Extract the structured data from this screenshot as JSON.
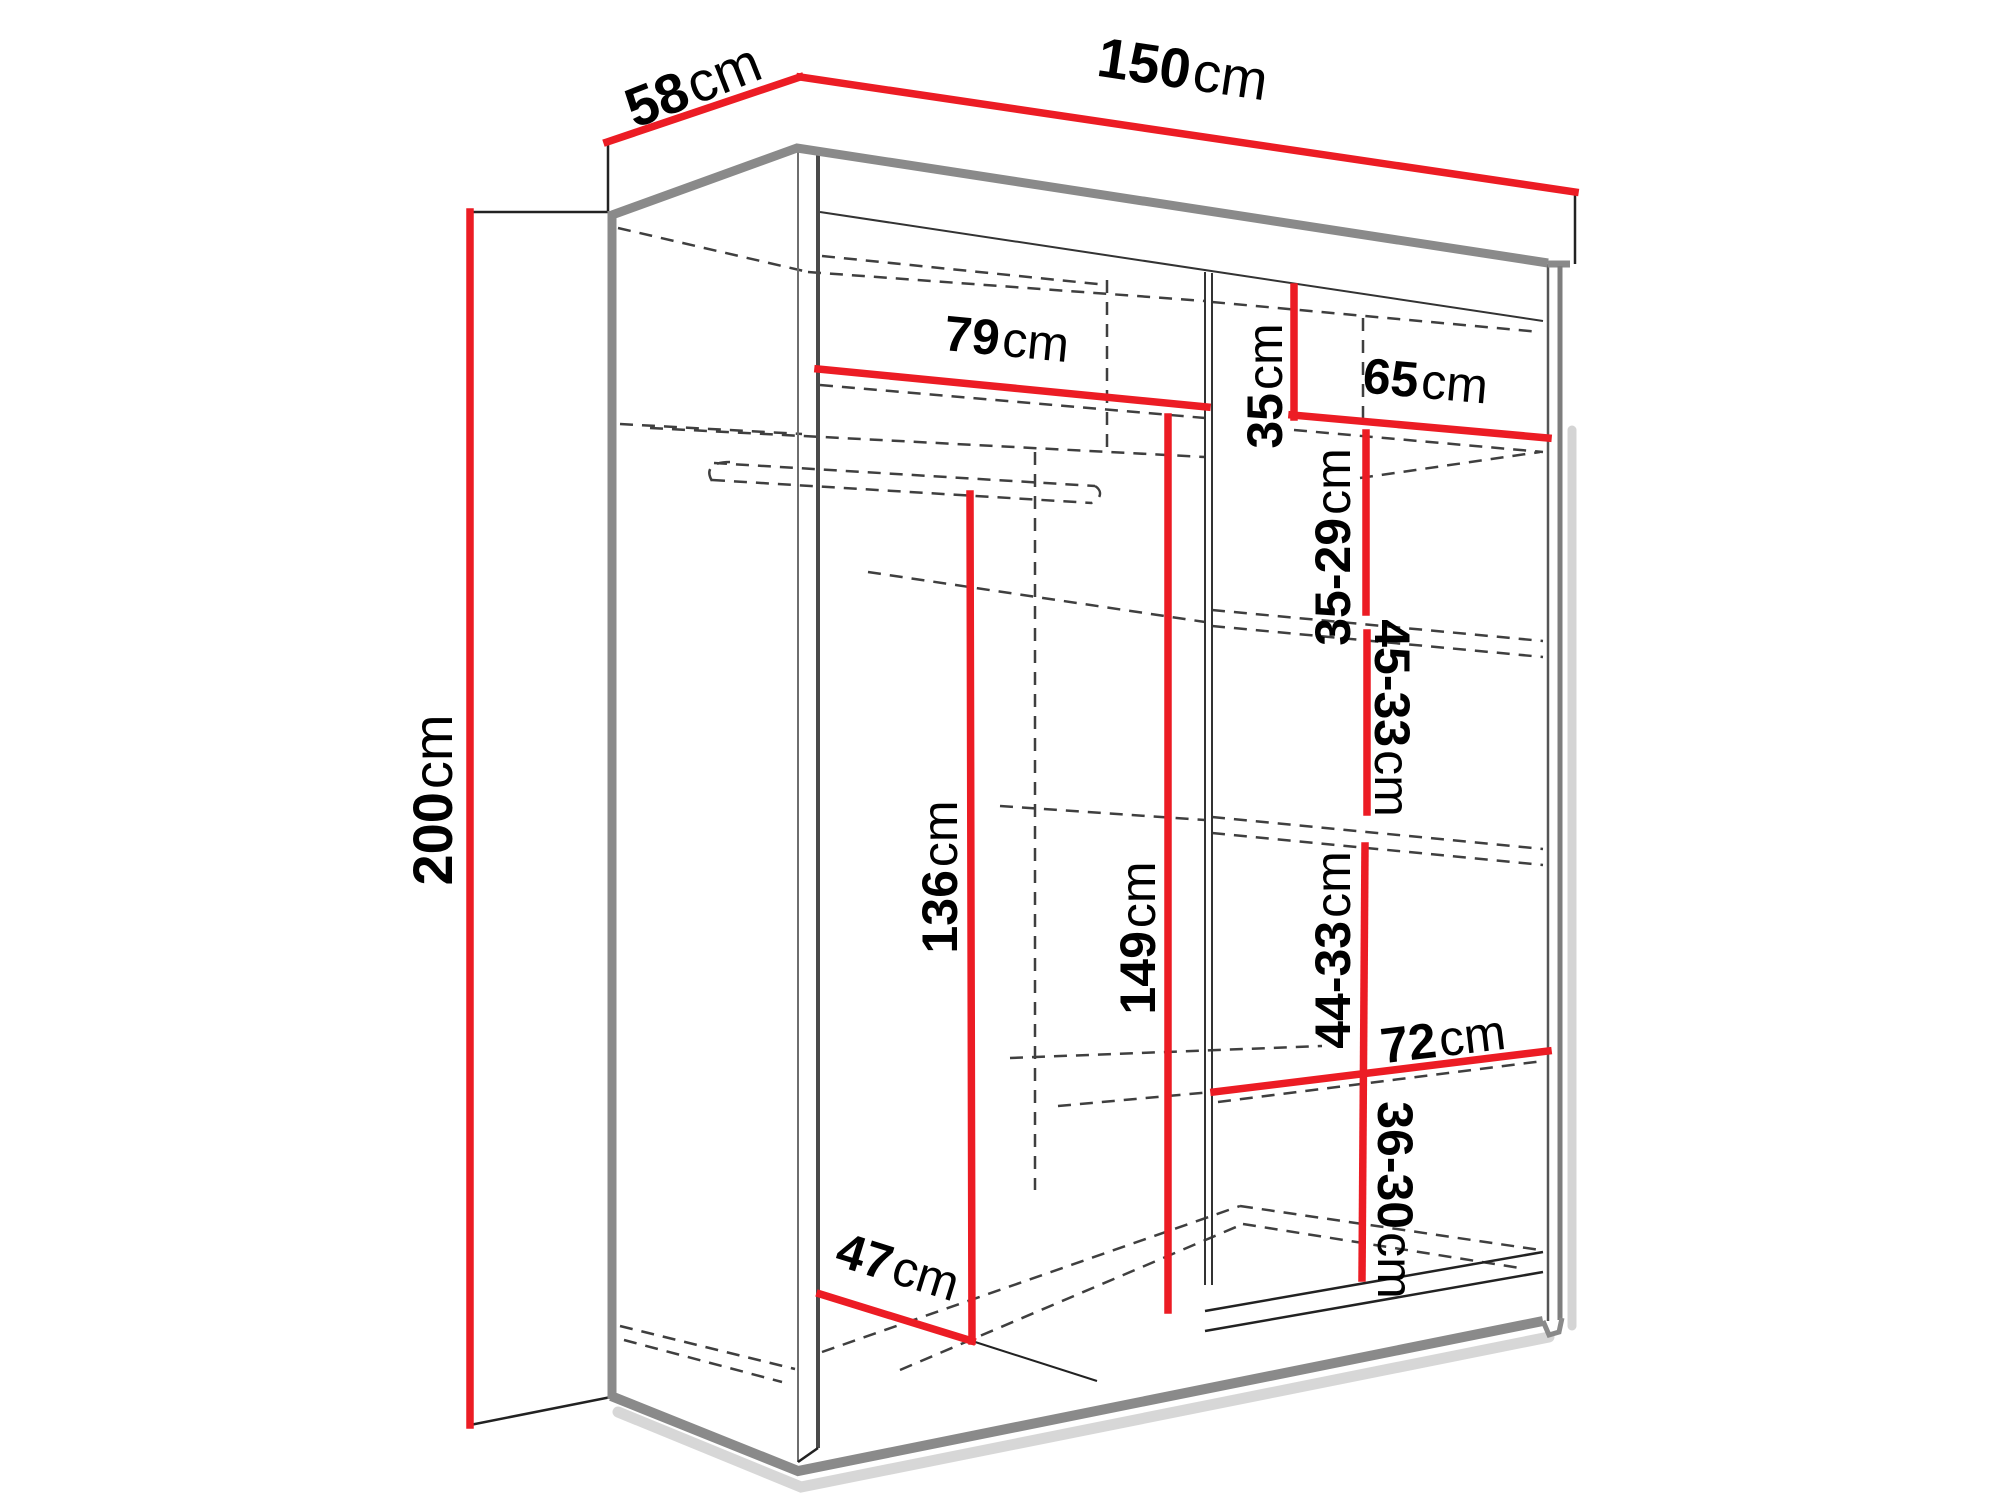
{
  "unit": "cm",
  "colors": {
    "dimension_line": "#ec1c24",
    "structure_line": "#8a8a8a",
    "edge_line": "#222222",
    "dashed_line": "#3f3f3f",
    "shadow": "#bdbdbd",
    "label_text": "#000000",
    "background": "#ffffff"
  },
  "dims": {
    "width": {
      "num": "150",
      "unit": "cm"
    },
    "depth": {
      "num": "58",
      "unit": "cm"
    },
    "height": {
      "num": "200",
      "unit": "cm"
    },
    "left_shelf": {
      "num": "79",
      "unit": "cm"
    },
    "top_gap": {
      "num": "35",
      "unit": "cm"
    },
    "right_shelf": {
      "num": "65",
      "unit": "cm"
    },
    "gap2": {
      "num": "35-29",
      "unit": "cm"
    },
    "gap3": {
      "num": "45-33",
      "unit": "cm"
    },
    "gap4": {
      "num": "44-33",
      "unit": "cm"
    },
    "bottom_shelf": {
      "num": "72",
      "unit": "cm"
    },
    "gap5": {
      "num": "36-30",
      "unit": "cm"
    },
    "hang_left": {
      "num": "136",
      "unit": "cm"
    },
    "hang_center": {
      "num": "149",
      "unit": "cm"
    },
    "floor_depth": {
      "num": "47",
      "unit": "cm"
    }
  }
}
